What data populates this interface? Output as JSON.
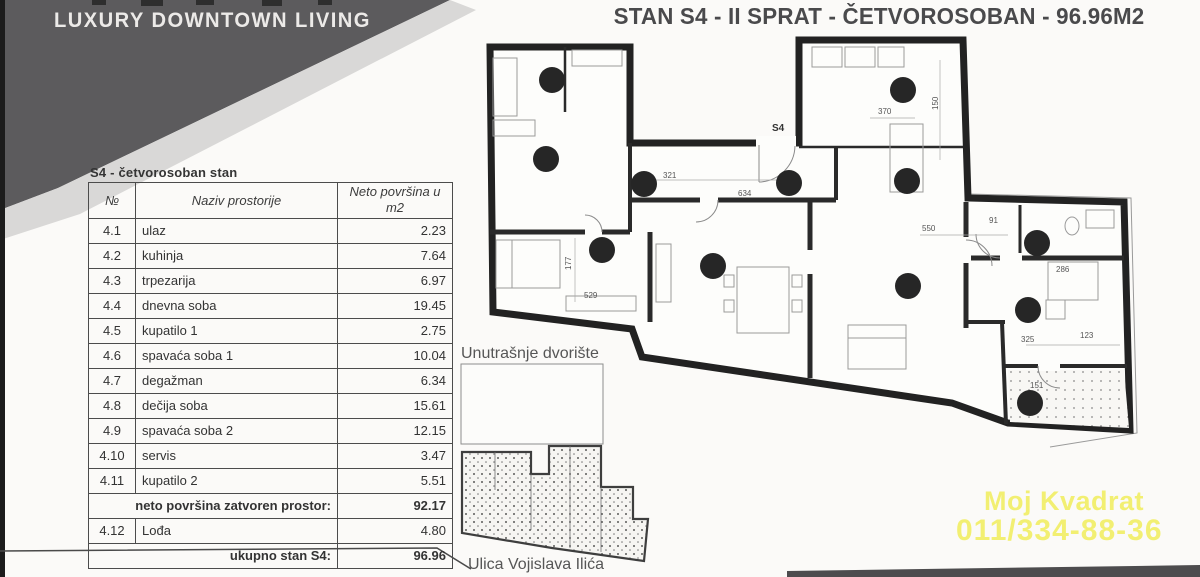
{
  "banner": {
    "title": "LUXURY DOWNTOWN LIVING"
  },
  "header": {
    "title": "STAN S4 - II SPRAT - ČETVOROSOBAN - 96.96M2"
  },
  "area_table": {
    "caption": "S4 - četvorosoban stan",
    "col_no": "№",
    "col_name": "Naziv prostorije",
    "col_area": "Neto površina u m2",
    "rows": [
      {
        "no": "4.1",
        "name": "ulaz",
        "area": "2.23"
      },
      {
        "no": "4.2",
        "name": "kuhinja",
        "area": "7.64"
      },
      {
        "no": "4.3",
        "name": "trpezarija",
        "area": "6.97"
      },
      {
        "no": "4.4",
        "name": "dnevna soba",
        "area": "19.45"
      },
      {
        "no": "4.5",
        "name": "kupatilo 1",
        "area": "2.75"
      },
      {
        "no": "4.6",
        "name": "spavaća soba 1",
        "area": "10.04"
      },
      {
        "no": "4.7",
        "name": "degažman",
        "area": "6.34"
      },
      {
        "no": "4.8",
        "name": "dečija soba",
        "area": "15.61"
      },
      {
        "no": "4.9",
        "name": "spavaća soba 2",
        "area": "12.15"
      },
      {
        "no": "4.10",
        "name": "servis",
        "area": "3.47"
      },
      {
        "no": "4.11",
        "name": "kupatilo 2",
        "area": "5.51"
      }
    ],
    "subtotal_label": "neto površina zatvoren prostor:",
    "subtotal_value": "92.17",
    "loggia_row": {
      "no": "4.12",
      "name": "Lođa",
      "area": "4.80"
    },
    "total_label": "ukupno stan S4:",
    "total_value": "96.96"
  },
  "site_plan": {
    "courtyard_label": "Unutrašnje dvorište",
    "street_label": "Ulica Vojislava Ilića"
  },
  "floor_plan": {
    "entrance_label": "S4",
    "dimensions": [
      "321",
      "634",
      "177",
      "529",
      "370",
      "150",
      "550",
      "286",
      "123",
      "325",
      "151",
      "91"
    ]
  },
  "watermark": {
    "line1": "Moj Kvadrat",
    "line2": "011/334-88-36",
    "color": "#f2ef67"
  }
}
